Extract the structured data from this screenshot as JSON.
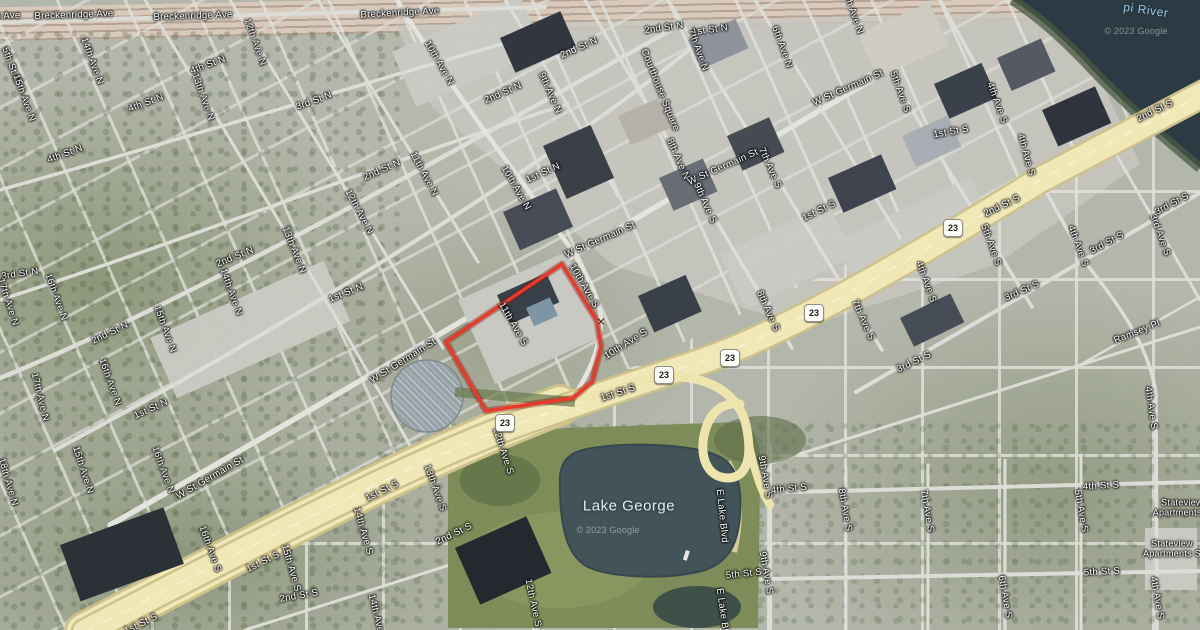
{
  "map": {
    "attribution": "© 2023 Google",
    "highlight": {
      "color": "#e8392a",
      "points": [
        [
          562,
          264
        ],
        [
          597,
          321
        ],
        [
          601,
          347
        ],
        [
          592,
          382
        ],
        [
          573,
          398
        ],
        [
          486,
          411
        ],
        [
          446,
          342
        ]
      ]
    },
    "marker": {
      "symbol": "×",
      "x": 601,
      "y": 322
    },
    "shields": [
      {
        "text": "23",
        "x": 505,
        "y": 423
      },
      {
        "text": "23",
        "x": 664,
        "y": 375
      },
      {
        "text": "23",
        "x": 730,
        "y": 358
      },
      {
        "text": "23",
        "x": 814,
        "y": 313
      },
      {
        "text": "23",
        "x": 953,
        "y": 228
      }
    ],
    "labels": [
      {
        "t": "e Ave",
        "x": 8,
        "y": 16,
        "r": -2
      },
      {
        "t": "Breckenridge Ave",
        "x": 74,
        "y": 15,
        "r": -2
      },
      {
        "t": "Breckenridge Ave",
        "x": 193,
        "y": 16,
        "r": -2
      },
      {
        "t": "Breckenridge Ave",
        "x": 400,
        "y": 13,
        "r": -3
      },
      {
        "t": "5th St N",
        "x": 11,
        "y": 65,
        "r": 70
      },
      {
        "t": "15th Ave N",
        "x": 24,
        "y": 98,
        "r": 70
      },
      {
        "t": "14th Ave N",
        "x": 92,
        "y": 61,
        "r": 70
      },
      {
        "t": "4th St N",
        "x": 208,
        "y": 65,
        "r": -20
      },
      {
        "t": "13th Ave N",
        "x": 203,
        "y": 97,
        "r": 70
      },
      {
        "t": "12th Ave N",
        "x": 255,
        "y": 42,
        "r": 70
      },
      {
        "t": "4th St N",
        "x": 146,
        "y": 103,
        "r": -20
      },
      {
        "t": "3rd St N",
        "x": 314,
        "y": 101,
        "r": -20
      },
      {
        "t": "2nd St N",
        "x": 664,
        "y": 28,
        "r": -8
      },
      {
        "t": "1st St N",
        "x": 710,
        "y": 30,
        "r": -8
      },
      {
        "t": "2nd St N",
        "x": 579,
        "y": 48,
        "r": -24
      },
      {
        "t": "7th Ave N",
        "x": 698,
        "y": 50,
        "r": 70
      },
      {
        "t": "6th Ave N",
        "x": 782,
        "y": 47,
        "r": 70
      },
      {
        "t": "10th Ave N",
        "x": 439,
        "y": 63,
        "r": 60
      },
      {
        "t": "2nd St N",
        "x": 503,
        "y": 93,
        "r": -24
      },
      {
        "t": "9th Ave N",
        "x": 550,
        "y": 93,
        "r": 66
      },
      {
        "t": "Courthouse Square",
        "x": 660,
        "y": 90,
        "r": 68
      },
      {
        "t": "5th Ave N",
        "x": 853,
        "y": 13,
        "r": 70
      },
      {
        "t": "W St Germain St",
        "x": 848,
        "y": 88,
        "r": -24
      },
      {
        "t": "5th Ave S",
        "x": 900,
        "y": 92,
        "r": 70
      },
      {
        "t": "4th Ave S",
        "x": 997,
        "y": 103,
        "r": 70
      },
      {
        "t": "pi River",
        "x": 1146,
        "y": 10,
        "r": 8,
        "k": "water"
      },
      {
        "t": "© 2023 Google",
        "x": 1136,
        "y": 31,
        "r": 0,
        "k": "wm"
      },
      {
        "t": "2nd St S",
        "x": 1155,
        "y": 111,
        "r": -26
      },
      {
        "t": "4th St N",
        "x": 65,
        "y": 154,
        "r": -20
      },
      {
        "t": "2nd St N",
        "x": 382,
        "y": 170,
        "r": -24
      },
      {
        "t": "11th Ave N",
        "x": 424,
        "y": 174,
        "r": 62
      },
      {
        "t": "1st St N",
        "x": 543,
        "y": 173,
        "r": -24
      },
      {
        "t": "8th Ave N",
        "x": 678,
        "y": 159,
        "r": 66
      },
      {
        "t": "W St Germain St",
        "x": 723,
        "y": 167,
        "r": -24
      },
      {
        "t": "7th Ave S",
        "x": 770,
        "y": 168,
        "r": 66
      },
      {
        "t": "10th Ave N",
        "x": 516,
        "y": 188,
        "r": 60
      },
      {
        "t": "12th Ave N",
        "x": 359,
        "y": 212,
        "r": 62
      },
      {
        "t": "9th Ave S",
        "x": 705,
        "y": 203,
        "r": 66
      },
      {
        "t": "1st St S",
        "x": 951,
        "y": 132,
        "r": -10
      },
      {
        "t": "4th Ave S",
        "x": 1026,
        "y": 155,
        "r": 74
      },
      {
        "t": "1st St S",
        "x": 819,
        "y": 211,
        "r": -26
      },
      {
        "t": "2nd St S",
        "x": 1002,
        "y": 206,
        "r": -26
      },
      {
        "t": "3rd St S",
        "x": 1172,
        "y": 204,
        "r": -28
      },
      {
        "t": "3rd Ave S",
        "x": 1160,
        "y": 235,
        "r": 70
      },
      {
        "t": "5th Ave S",
        "x": 991,
        "y": 245,
        "r": 70
      },
      {
        "t": "3rd St S",
        "x": 1107,
        "y": 243,
        "r": -28
      },
      {
        "t": "4th Ave S",
        "x": 1078,
        "y": 246,
        "r": 70
      },
      {
        "t": "2nd St N",
        "x": 235,
        "y": 257,
        "r": -22
      },
      {
        "t": "13th Ave N",
        "x": 294,
        "y": 250,
        "r": 68
      },
      {
        "t": "W St Germain St",
        "x": 600,
        "y": 240,
        "r": -24
      },
      {
        "t": "3rd St N",
        "x": 20,
        "y": 274,
        "r": -8
      },
      {
        "t": "17th Ave N",
        "x": 8,
        "y": 302,
        "r": 72
      },
      {
        "t": "16th Ave N",
        "x": 56,
        "y": 297,
        "r": 70
      },
      {
        "t": "1st St N",
        "x": 346,
        "y": 293,
        "r": -22
      },
      {
        "t": "14th Ave N",
        "x": 231,
        "y": 292,
        "r": 70
      },
      {
        "t": "4th Ave S",
        "x": 926,
        "y": 282,
        "r": 70
      },
      {
        "t": "3rd St S",
        "x": 1022,
        "y": 291,
        "r": -24
      },
      {
        "t": "10th Ave S",
        "x": 584,
        "y": 286,
        "r": 60
      },
      {
        "t": "8th Ave S",
        "x": 768,
        "y": 311,
        "r": 66
      },
      {
        "t": "2nd St N",
        "x": 110,
        "y": 333,
        "r": -26
      },
      {
        "t": "15th Ave N",
        "x": 165,
        "y": 329,
        "r": 70
      },
      {
        "t": "11th Ave S",
        "x": 513,
        "y": 324,
        "r": 60
      },
      {
        "t": "7th Ave S",
        "x": 863,
        "y": 320,
        "r": 66
      },
      {
        "t": "Ramsey Pl",
        "x": 1137,
        "y": 332,
        "r": -22
      },
      {
        "t": "10th Ave S",
        "x": 626,
        "y": 344,
        "r": -32
      },
      {
        "t": "W St Germain St",
        "x": 403,
        "y": 361,
        "r": -32
      },
      {
        "t": "3rd St S",
        "x": 914,
        "y": 362,
        "r": -26
      },
      {
        "t": "17th Ave N",
        "x": 40,
        "y": 397,
        "r": 76
      },
      {
        "t": "16th Ave N",
        "x": 110,
        "y": 382,
        "r": 70
      },
      {
        "t": "1st St N",
        "x": 151,
        "y": 409,
        "r": -24
      },
      {
        "t": "1st St S",
        "x": 618,
        "y": 393,
        "r": -18
      },
      {
        "t": "4th Ave S",
        "x": 1151,
        "y": 408,
        "r": 82
      },
      {
        "t": "12th Ave S",
        "x": 503,
        "y": 451,
        "r": 72
      },
      {
        "t": "15th Ave N",
        "x": 83,
        "y": 470,
        "r": 72
      },
      {
        "t": "16th Ave N",
        "x": 163,
        "y": 470,
        "r": 70
      },
      {
        "t": "18th Ave N",
        "x": 8,
        "y": 482,
        "r": 74
      },
      {
        "t": "W St Germain St",
        "x": 210,
        "y": 478,
        "r": -30
      },
      {
        "t": "1st St S",
        "x": 382,
        "y": 491,
        "r": -26
      },
      {
        "t": "13th Ave S",
        "x": 435,
        "y": 488,
        "r": 70
      },
      {
        "t": "9th Ave S",
        "x": 765,
        "y": 477,
        "r": 80
      },
      {
        "t": "4th St S",
        "x": 789,
        "y": 489,
        "r": -6
      },
      {
        "t": "4th St S",
        "x": 1101,
        "y": 486,
        "r": -3
      },
      {
        "t": "Lake George",
        "x": 629,
        "y": 506,
        "r": 0,
        "k": "lake"
      },
      {
        "t": "E Lake Blvd",
        "x": 722,
        "y": 516,
        "r": 84
      },
      {
        "t": "5th Ave S",
        "x": 1081,
        "y": 511,
        "r": 80
      },
      {
        "t": "8th Ave S",
        "x": 845,
        "y": 510,
        "r": 80
      },
      {
        "t": "7th Ave S",
        "x": 927,
        "y": 511,
        "r": 80
      },
      {
        "t": "Stateview",
        "t2": "Apartments N",
        "x": 1182,
        "y": 508,
        "r": 0,
        "k": "poi"
      },
      {
        "t": "© 2023 Google",
        "x": 608,
        "y": 530,
        "r": 0,
        "k": "wm"
      },
      {
        "t": "14th Ave S",
        "x": 363,
        "y": 531,
        "r": 74
      },
      {
        "t": "2nd St S",
        "x": 454,
        "y": 534,
        "r": -26
      },
      {
        "t": "16th Ave S",
        "x": 210,
        "y": 549,
        "r": 70
      },
      {
        "t": "Stateview",
        "t2": "Apartments S",
        "x": 1172,
        "y": 549,
        "r": 0,
        "k": "poi"
      },
      {
        "t": "1st St S",
        "x": 263,
        "y": 562,
        "r": -26
      },
      {
        "t": "15th Ave S",
        "x": 291,
        "y": 568,
        "r": 74
      },
      {
        "t": "5th St S",
        "x": 744,
        "y": 574,
        "r": -6
      },
      {
        "t": "9th Ave S",
        "x": 766,
        "y": 573,
        "r": 80
      },
      {
        "t": "5th St S",
        "x": 1102,
        "y": 572,
        "r": -3
      },
      {
        "t": "2nd St S",
        "x": 299,
        "y": 596,
        "r": -10
      },
      {
        "t": "6th Ave S",
        "x": 1005,
        "y": 597,
        "r": 80
      },
      {
        "t": "4th Ave S",
        "x": 1157,
        "y": 598,
        "r": 80
      },
      {
        "t": "12th Ave S",
        "x": 533,
        "y": 603,
        "r": 78
      },
      {
        "t": "14th Ave S",
        "x": 377,
        "y": 618,
        "r": 76
      },
      {
        "t": "E Lake Blvd",
        "x": 723,
        "y": 615,
        "r": 82
      },
      {
        "t": "1st St S",
        "x": 141,
        "y": 624,
        "r": -26
      }
    ]
  }
}
